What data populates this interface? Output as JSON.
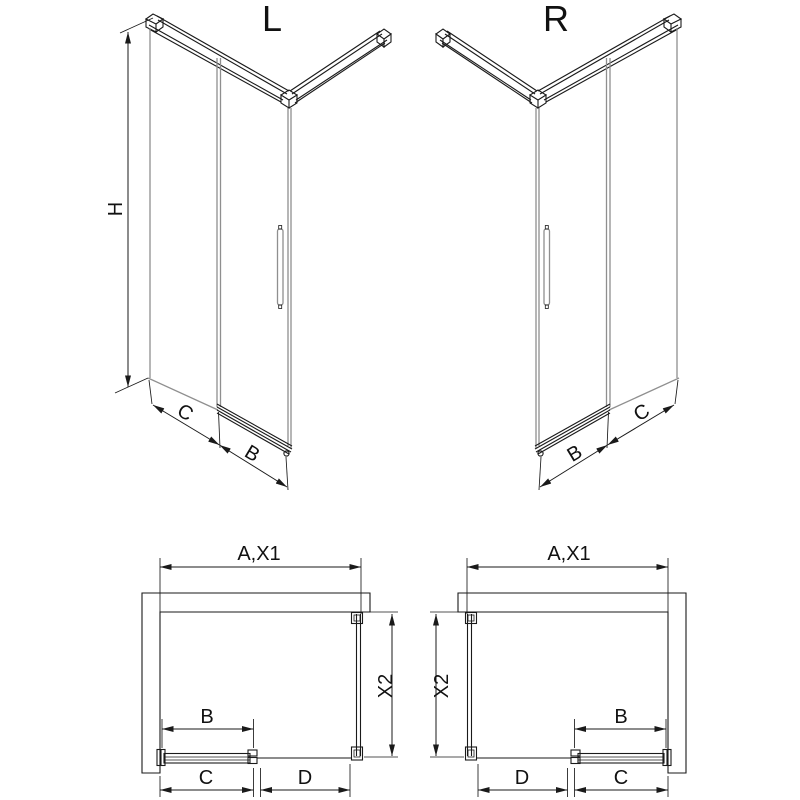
{
  "figure": {
    "type": "shower-enclosure-technical-drawing",
    "background": "#ffffff",
    "line_color": "#1a1a1a",
    "glass_line_color": "#8f8f8f"
  },
  "iso_left": {
    "variant_label": "L",
    "height_dim": "H",
    "side_dim": "C",
    "door_dim": "B"
  },
  "iso_right": {
    "variant_label": "R",
    "side_dim": "C",
    "door_dim": "B"
  },
  "plan_left": {
    "width_dim": "A,X1",
    "depth_dim": "X2",
    "door_dim": "B",
    "bottom_left_dim": "C",
    "bottom_right_dim": "D"
  },
  "plan_right": {
    "width_dim": "A,X1",
    "depth_dim": "X2",
    "door_dim": "B",
    "bottom_left_dim": "D",
    "bottom_right_dim": "C"
  }
}
